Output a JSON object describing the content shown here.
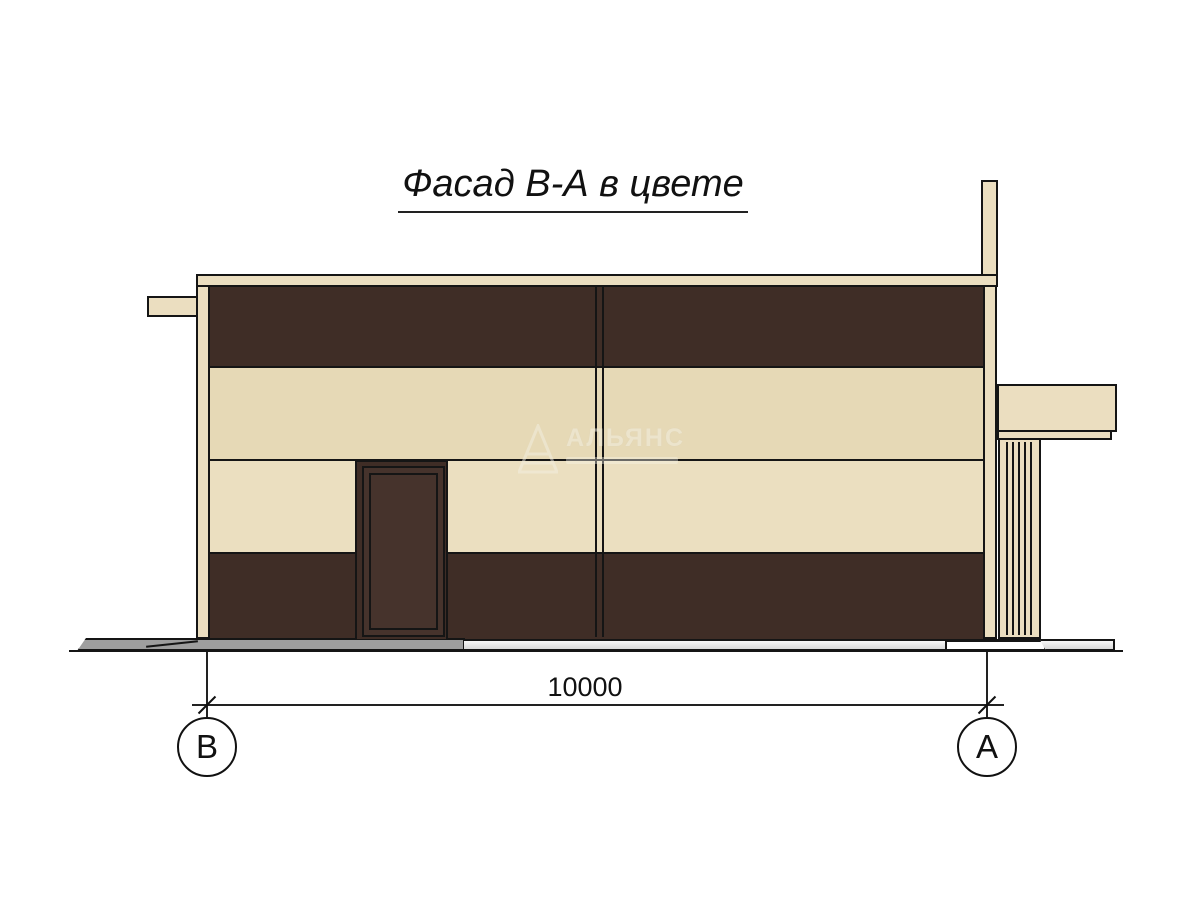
{
  "title": {
    "text": "Фасад В-А в цвете"
  },
  "dimension": {
    "value": "10000"
  },
  "axes": {
    "left": {
      "label": "В"
    },
    "right": {
      "label": "А"
    }
  },
  "watermark": {
    "text": "АЛЬЯНС"
  },
  "colors": {
    "cream": "#ebdec0",
    "cream_band2": "#e6d9b6",
    "cream_band3": "#ebdfc0",
    "brown": "#3f2d26",
    "door": "#46332c",
    "outline": "#151515",
    "walk_gray": "#9e9e9e",
    "walk_light": "#d9d9d9",
    "walk_white": "#ffffff"
  }
}
